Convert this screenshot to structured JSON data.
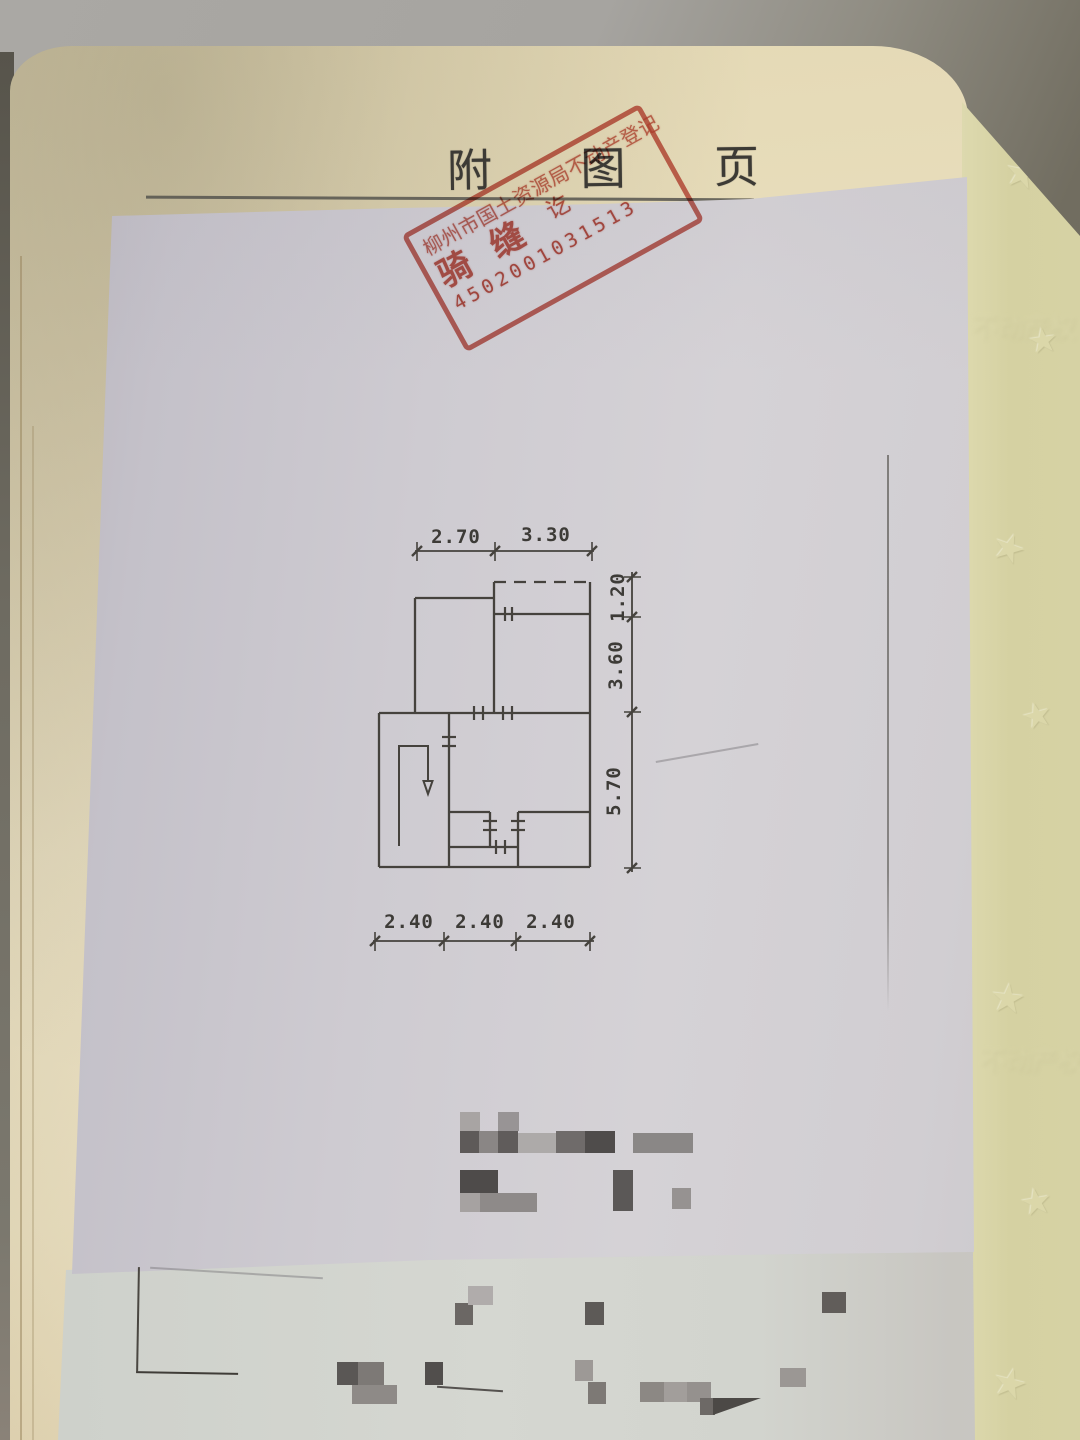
{
  "document": {
    "page_title": "附  图  页",
    "stamp": {
      "agency_line": "柳州市国土资源局不动产登记",
      "big_char_1": "骑",
      "big_char_2": "缝",
      "small_char": "讫",
      "serial_number": "4502001031513",
      "ink_color": "#c2493c"
    },
    "floor_plan": {
      "top_dimensions": [
        "2.70",
        "3.30"
      ],
      "right_dimensions": [
        "1.20",
        "3.60",
        "5.70"
      ],
      "bottom_dimensions": [
        "2.40",
        "2.40",
        "2.40"
      ]
    }
  },
  "colors": {
    "booklet_page": "#ebe0bf",
    "right_page": "#d6d2a4",
    "drawing_sheet": "#cfccd2",
    "bottom_sheet": "#d2d5cf",
    "line_ink": "#45423d",
    "stamp_red": "#c2493c",
    "background": "#8f8c82"
  }
}
